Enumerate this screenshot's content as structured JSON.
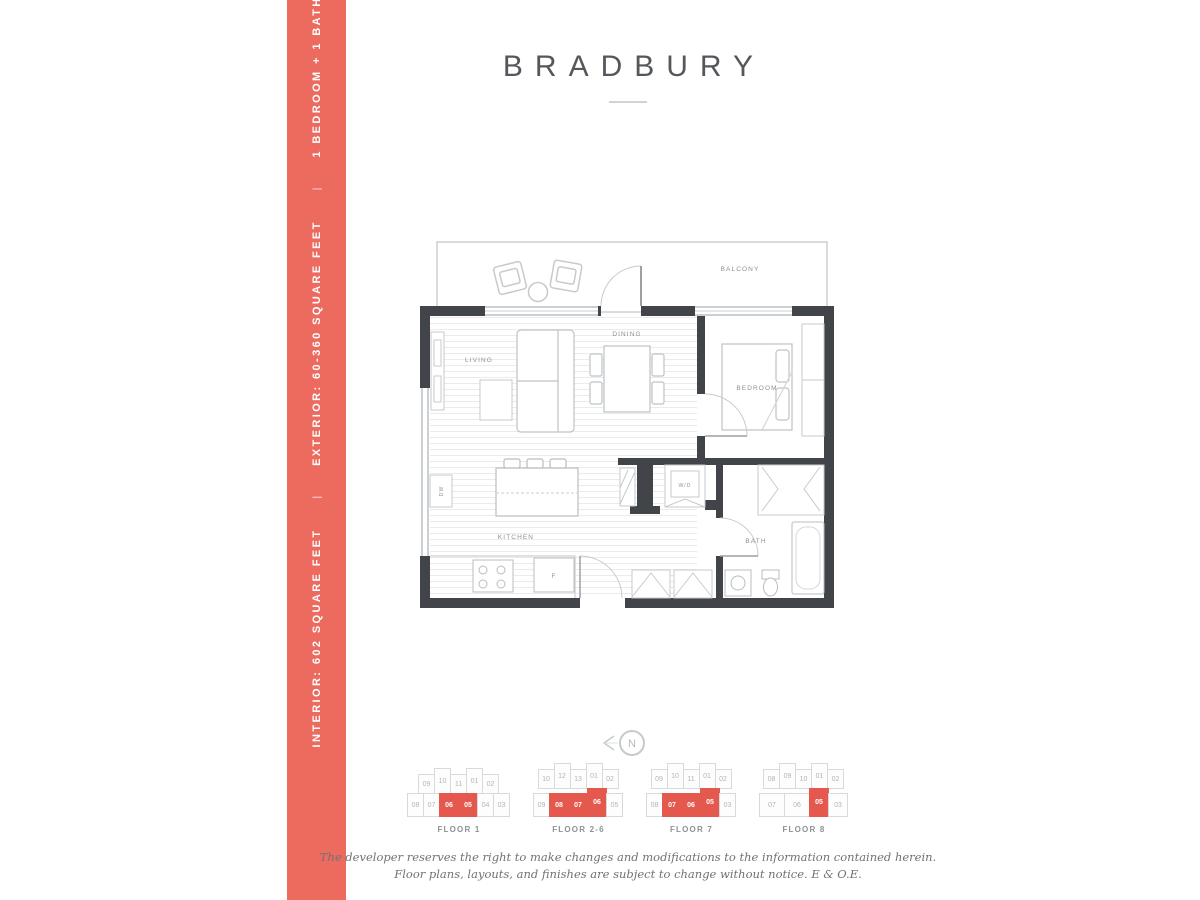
{
  "sidebar": {
    "color": "#ED6A5F",
    "separator": "|",
    "items": [
      "INTERIOR: 602 SQUARE FEET",
      "EXTERIOR: 60-360 SQUARE FEET",
      "1 BEDROOM + 1 BATHROOM"
    ]
  },
  "header": {
    "title": "BRADBURY"
  },
  "floor_plan": {
    "labels": {
      "balcony": "BALCONY",
      "living": "LIVING",
      "dining": "DINING",
      "bedroom": "BEDROOM",
      "kitchen": "KITCHEN",
      "bath": "BATH",
      "washer_dryer": "W/D",
      "dishwasher": "DW",
      "fridge": "F"
    }
  },
  "compass": {
    "label": "N"
  },
  "keyplan_highlight_color": "#E4584E",
  "keyplans": [
    {
      "label": "FLOOR 1",
      "rows": [
        [
          {
            "n": "09"
          },
          {
            "n": "10",
            "up": true
          },
          {
            "n": "11"
          },
          {
            "n": "01",
            "up": true
          },
          {
            "n": "02"
          }
        ],
        [
          {
            "n": "08"
          },
          {
            "n": "07"
          },
          {
            "n": "06",
            "hl": true,
            "w": 20
          },
          {
            "n": "05",
            "hl": true,
            "w": 20
          },
          {
            "n": "04"
          },
          {
            "n": "03"
          }
        ]
      ]
    },
    {
      "label": "FLOOR 2-6",
      "rows": [
        [
          {
            "n": "10"
          },
          {
            "n": "12",
            "up": true
          },
          {
            "n": "13"
          },
          {
            "n": "01",
            "up": true
          },
          {
            "n": "02"
          }
        ],
        [
          {
            "n": "09"
          },
          {
            "n": "08",
            "hl": true,
            "w": 20
          },
          {
            "n": "07",
            "hl": true,
            "w": 20
          },
          {
            "n": "06",
            "hl": true,
            "w": 20,
            "up": true
          },
          {
            "n": "05"
          }
        ]
      ]
    },
    {
      "label": "FLOOR 7",
      "rows": [
        [
          {
            "n": "09"
          },
          {
            "n": "10",
            "up": true
          },
          {
            "n": "11"
          },
          {
            "n": "01",
            "up": true
          },
          {
            "n": "02"
          }
        ],
        [
          {
            "n": "08"
          },
          {
            "n": "07",
            "hl": true,
            "w": 20
          },
          {
            "n": "06",
            "hl": true,
            "w": 20
          },
          {
            "n": "05",
            "hl": true,
            "w": 20,
            "up": true
          },
          {
            "n": "03"
          }
        ]
      ]
    },
    {
      "label": "FLOOR 8",
      "rows": [
        [
          {
            "n": "08"
          },
          {
            "n": "09",
            "up": true
          },
          {
            "n": "10"
          },
          {
            "n": "01",
            "up": true
          },
          {
            "n": "02"
          }
        ],
        [
          {
            "n": "07",
            "w": 26
          },
          {
            "n": "06",
            "w": 26
          },
          {
            "n": "05",
            "hl": true,
            "w": 20,
            "up": true
          },
          {
            "n": "03",
            "w": 20
          }
        ]
      ]
    }
  ],
  "disclaimer": {
    "line1": "The developer reserves the right to make changes and modifications to the information contained herein.",
    "line2": "Floor plans, layouts, and finishes are subject to change without notice. E & O.E."
  }
}
